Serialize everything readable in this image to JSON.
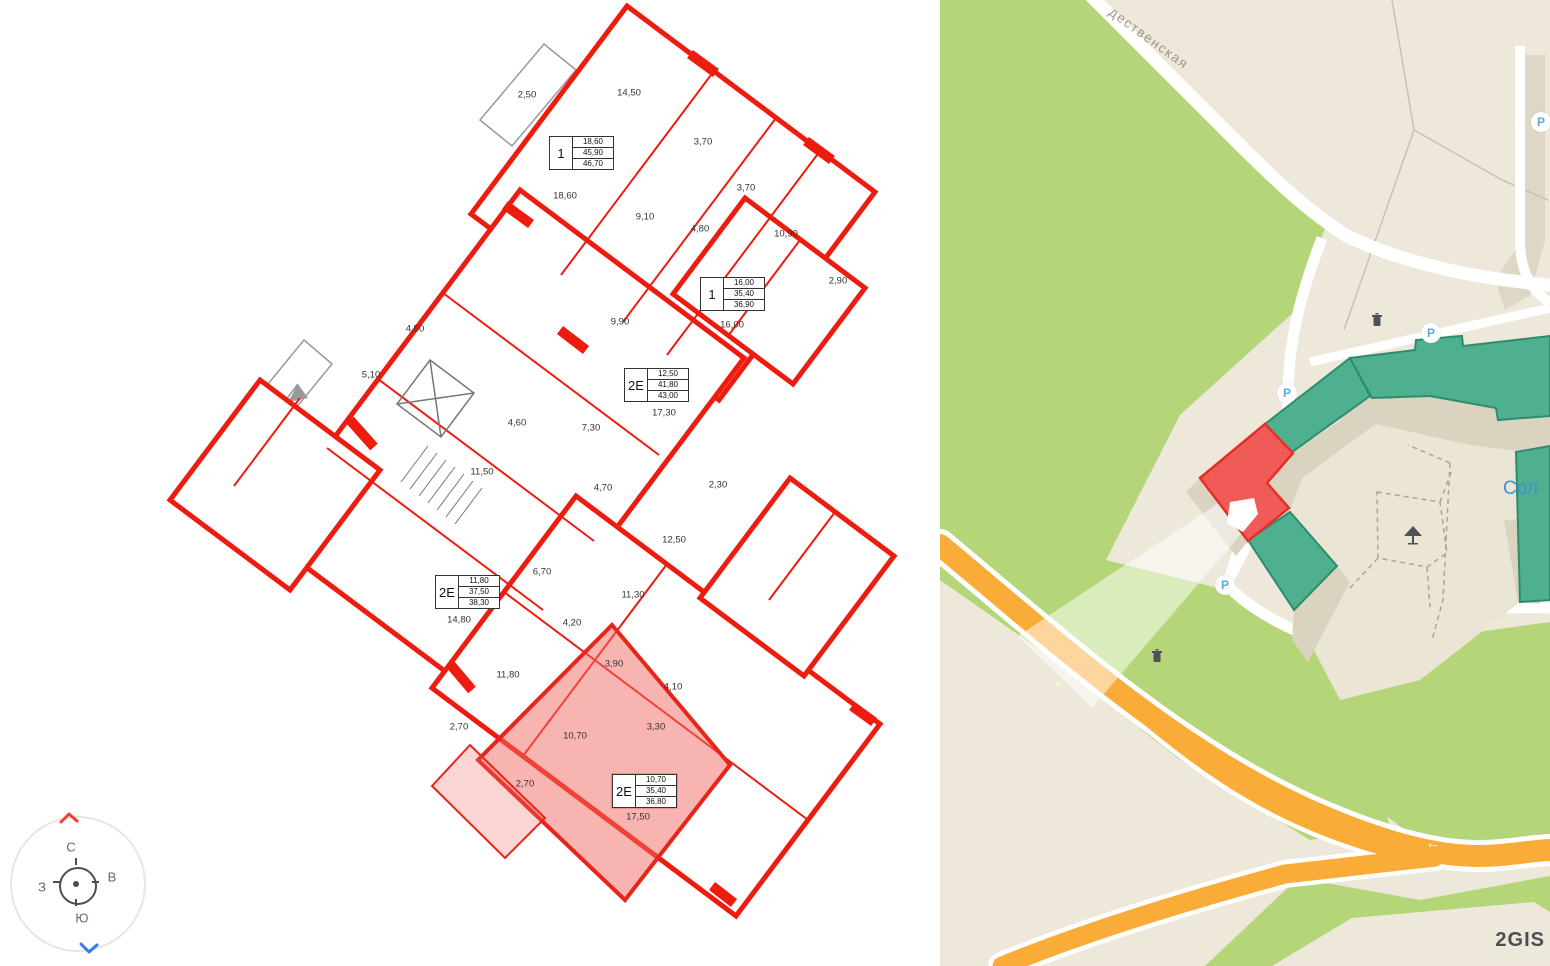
{
  "floor_plan": {
    "rooms": [
      {
        "label": "2,50",
        "x": 527,
        "y": 95
      },
      {
        "label": "14,50",
        "x": 629,
        "y": 93
      },
      {
        "label": "3,70",
        "x": 703,
        "y": 142
      },
      {
        "label": "18,60",
        "x": 565,
        "y": 196
      },
      {
        "label": "9,10",
        "x": 645,
        "y": 217
      },
      {
        "label": "4,80",
        "x": 700,
        "y": 229
      },
      {
        "label": "3,70",
        "x": 746,
        "y": 188
      },
      {
        "label": "10,90",
        "x": 786,
        "y": 234
      },
      {
        "label": "2,90",
        "x": 838,
        "y": 281
      },
      {
        "label": "16,00",
        "x": 732,
        "y": 325
      },
      {
        "label": "9,90",
        "x": 620,
        "y": 322
      },
      {
        "label": "4,50",
        "x": 415,
        "y": 329
      },
      {
        "label": "5,10",
        "x": 371,
        "y": 375
      },
      {
        "label": "17,30",
        "x": 664,
        "y": 413
      },
      {
        "label": "4,60",
        "x": 517,
        "y": 423
      },
      {
        "label": "7,30",
        "x": 591,
        "y": 428
      },
      {
        "label": "11,50",
        "x": 482,
        "y": 472
      },
      {
        "label": "4,70",
        "x": 603,
        "y": 488
      },
      {
        "label": "2,30",
        "x": 718,
        "y": 485
      },
      {
        "label": "12,50",
        "x": 674,
        "y": 540
      },
      {
        "label": "6,70",
        "x": 542,
        "y": 572
      },
      {
        "label": "11,30",
        "x": 633,
        "y": 595
      },
      {
        "label": "4,20",
        "x": 572,
        "y": 623
      },
      {
        "label": "14,80",
        "x": 459,
        "y": 620
      },
      {
        "label": "3,90",
        "x": 614,
        "y": 664
      },
      {
        "label": "11,80",
        "x": 508,
        "y": 675
      },
      {
        "label": "4,10",
        "x": 673,
        "y": 687
      },
      {
        "label": "2,70",
        "x": 459,
        "y": 727
      },
      {
        "label": "10,70",
        "x": 575,
        "y": 736
      },
      {
        "label": "3,30",
        "x": 656,
        "y": 727
      },
      {
        "label": "2,70",
        "x": 525,
        "y": 784
      },
      {
        "label": "17,50",
        "x": 638,
        "y": 817
      }
    ],
    "units": [
      {
        "type": "1",
        "v1": "18,60",
        "v2": "45,90",
        "v3": "46,70",
        "x": 549,
        "y": 136
      },
      {
        "type": "1",
        "v1": "16,00",
        "v2": "35,40",
        "v3": "36,90",
        "x": 700,
        "y": 277
      },
      {
        "type": "2Е",
        "v1": "12,50",
        "v2": "41,80",
        "v3": "43,00",
        "x": 624,
        "y": 368
      },
      {
        "type": "2Е",
        "v1": "11,80",
        "v2": "37,50",
        "v3": "38,30",
        "x": 435,
        "y": 575
      },
      {
        "type": "2Е",
        "v1": "10,70",
        "v2": "35,40",
        "v3": "36,80",
        "x": 612,
        "y": 774,
        "highlighted": true
      }
    ],
    "colors": {
      "wall_red": "#ed1c0f",
      "highlight_fill": "#f26a64"
    }
  },
  "compass": {
    "north": "С",
    "east": "В",
    "south": "Ю",
    "west": "З"
  },
  "map": {
    "street_label": "дественская",
    "place_label": "Сол",
    "watermark": "2GIS",
    "parking_letter": "Р",
    "arrow_glyph": "←",
    "parkings": [
      {
        "x": 1541,
        "y": 122
      },
      {
        "x": 1431,
        "y": 333
      },
      {
        "x": 1287,
        "y": 393
      },
      {
        "x": 1225,
        "y": 585
      }
    ],
    "colors": {
      "park_green": "#b4d678",
      "road_orange": "#f9ad38",
      "building_teal": "#4fb08f",
      "building_red": "#f05b57",
      "land_beige": "#ede8d9",
      "shadow": "#dad3c0"
    }
  }
}
